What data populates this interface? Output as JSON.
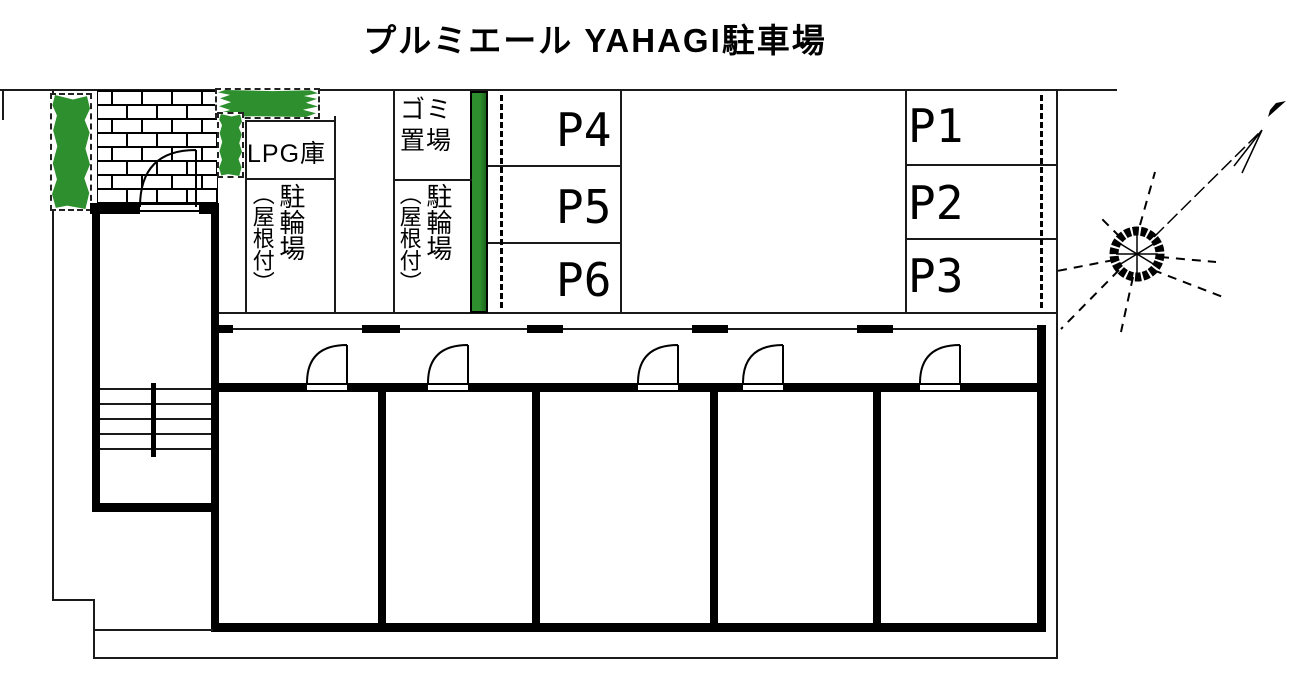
{
  "title": "プルミエール YAHAGI駐車場",
  "parking_spaces": [
    "P1",
    "P2",
    "P3",
    "P4",
    "P5",
    "P6"
  ],
  "facilities": {
    "lpg_storage": "LPG庫",
    "garbage_area": {
      "label": "ゴミ置場",
      "line1": "ゴミ",
      "line2": "置場"
    },
    "bicycle_parking_west": {
      "main": "駐輪場",
      "sub": "（屋根付）"
    },
    "bicycle_parking_center": {
      "main": "駐輪場",
      "sub": "（屋根付）"
    }
  },
  "icons": {
    "compass": "compass-rose-icon",
    "north_arrow": "north-arrow-icon",
    "doors": "door-swing-icon",
    "stairs": "stairs-icon"
  },
  "colors": {
    "line": "#000000",
    "planting_green": "#2d8f2d",
    "hedge_green": "#1c661c",
    "background": "#ffffff"
  }
}
